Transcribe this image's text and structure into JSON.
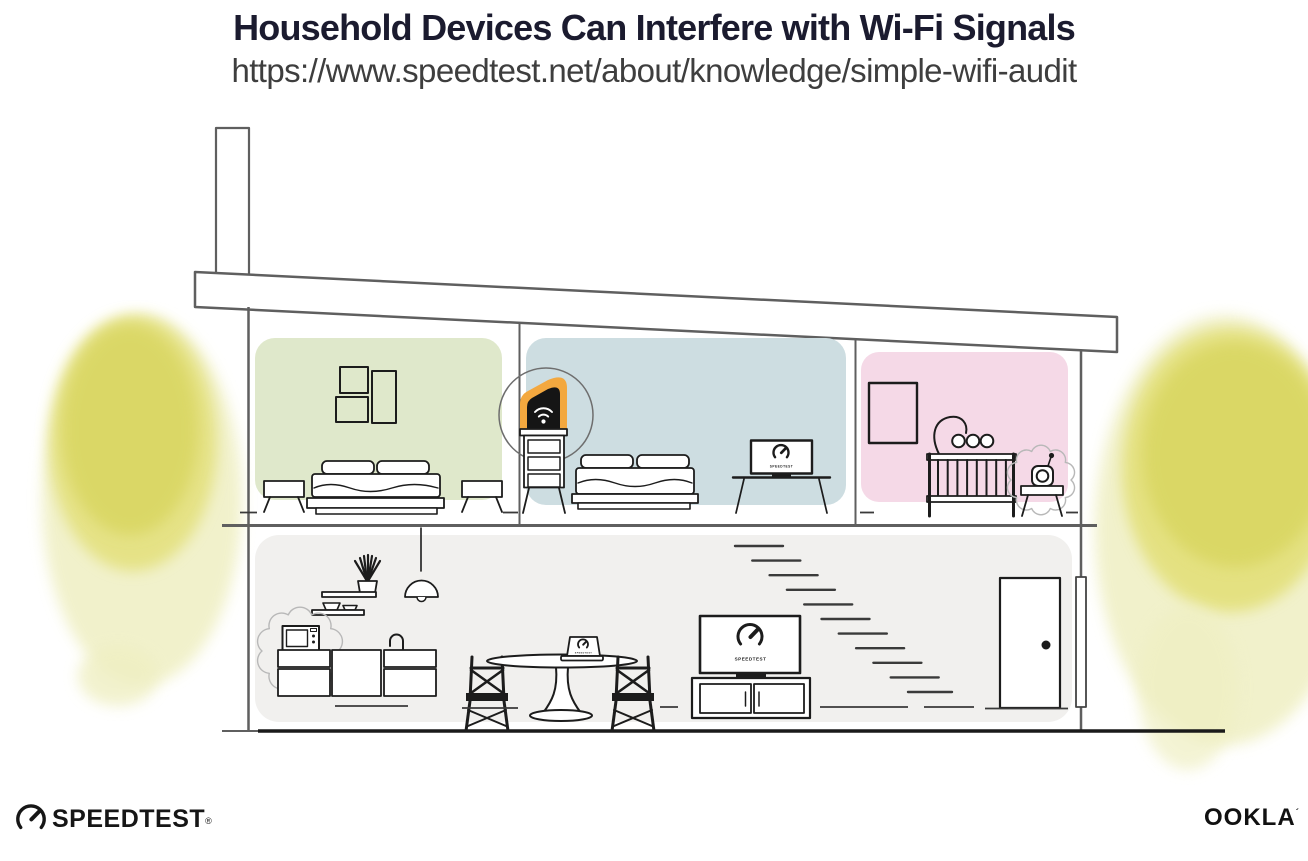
{
  "header": {
    "title": "Household Devices Can Interfere with Wi-Fi Signals",
    "url": "https://www.speedtest.net/about/knowledge/simple-wifi-audit"
  },
  "screens": {
    "tv": "SPEEDTEST",
    "bedroom_monitor": "SPEEDTEST",
    "dining_laptop": "SPEEDTEST"
  },
  "footer": {
    "speedtest_label": "SPEEDTEST",
    "speedtest_reg": "®",
    "ookla_label": "OOKLA",
    "ookla_mark": "´"
  },
  "colors": {
    "title_text": "#1b1b2f",
    "url_text": "#3e3e3e",
    "room_green": "#dfe8cb",
    "room_blue": "#cddde1",
    "room_pink": "#f5d9e7",
    "lower_floor": "#f1f0ee",
    "router_glow": "#f3a83f",
    "foliage_dark": "#d8d55e",
    "foliage_mid": "#e3e07a",
    "foliage_light": "#efefc2",
    "ink": "#1c1c1c",
    "structure": "#5f5f5f",
    "interference": "#b8b8b8"
  },
  "icons": {
    "router": "wifi-router-icon",
    "microwave": "microwave-icon",
    "baby_monitor": "baby-monitor-icon",
    "tv": "tv-icon",
    "gauge": "speedtest-gauge-icon"
  }
}
